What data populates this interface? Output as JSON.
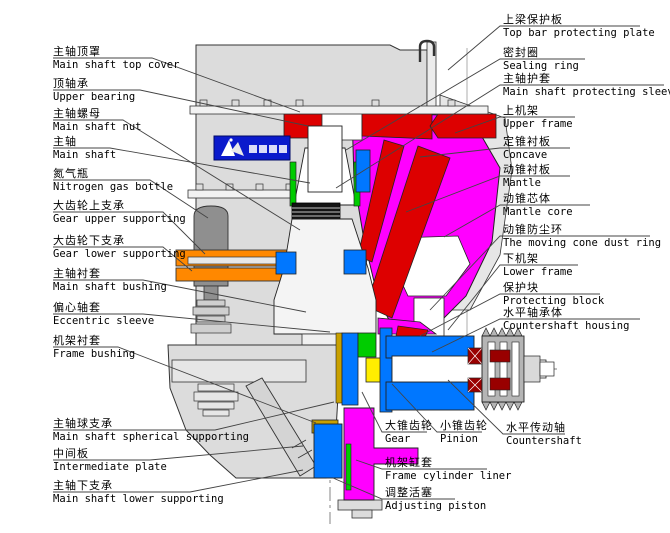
{
  "diagram_title": "cone-crusher-sectional-diagram",
  "brand_logo_icon": "mountain-mark-badge",
  "colors": {
    "mantle_core_magenta": "#ff00ff",
    "concave_red": "#dd0000",
    "frame_blue": "#0077ff",
    "gear_support_orange": "#ff8800",
    "liner_green": "#00cc00",
    "gear_yellow": "#ffee00",
    "bushing_gold": "#c8a000",
    "bearing_dark_red": "#990000",
    "body_gray": "#dcdcdc",
    "bottle_gray": "#8f8f8f",
    "logo_blue": "#0a1acc"
  },
  "labels": {
    "left": [
      {
        "cn": "主轴顶罩",
        "en": "Main shaft top cover"
      },
      {
        "cn": "顶轴承",
        "en": "Upper bearing"
      },
      {
        "cn": "主轴螺母",
        "en": "Main shaft nut"
      },
      {
        "cn": "主轴",
        "en": "Main shaft"
      },
      {
        "cn": "氮气瓶",
        "en": "Nitrogen gas bottle"
      },
      {
        "cn": "大齿轮上支承",
        "en": "Gear upper supporting"
      },
      {
        "cn": "大齿轮下支承",
        "en": "Gear lower supporting"
      },
      {
        "cn": "主轴衬套",
        "en": "Main shaft bushing"
      },
      {
        "cn": "偏心轴套",
        "en": "Eccentric sleeve"
      },
      {
        "cn": "机架衬套",
        "en": "Frame bushing"
      },
      {
        "cn": "主轴球支承",
        "en": "Main shaft spherical supporting"
      },
      {
        "cn": "中间板",
        "en": "Intermediate plate"
      },
      {
        "cn": "主轴下支承",
        "en": "Main shaft lower supporting"
      }
    ],
    "right": [
      {
        "cn": "上梁保护板",
        "en": "Top bar protecting plate"
      },
      {
        "cn": "密封圈",
        "en": "Sealing ring"
      },
      {
        "cn": "主轴护套",
        "en": "Main shaft protecting sleeve"
      },
      {
        "cn": "上机架",
        "en": "Upper frame"
      },
      {
        "cn": "定锥衬板",
        "en": "Concave"
      },
      {
        "cn": "动锥衬板",
        "en": "Mantle"
      },
      {
        "cn": "动锥芯体",
        "en": "Mantle core"
      },
      {
        "cn": "动锥防尘环",
        "en": "The moving cone dust ring"
      },
      {
        "cn": "下机架",
        "en": "Lower frame"
      },
      {
        "cn": "保护块",
        "en": "Protecting block"
      },
      {
        "cn": "水平轴承体",
        "en": "Countershaft housing"
      }
    ],
    "bottom": [
      {
        "cn": "大锥齿轮",
        "en": "Gear"
      },
      {
        "cn": "小锥齿轮",
        "en": "Pinion"
      },
      {
        "cn": "水平传动轴",
        "en": "Countershaft"
      },
      {
        "cn": "机架缸套",
        "en": "Frame cylinder liner"
      },
      {
        "cn": "调整活塞",
        "en": "Adjusting piston"
      }
    ]
  }
}
